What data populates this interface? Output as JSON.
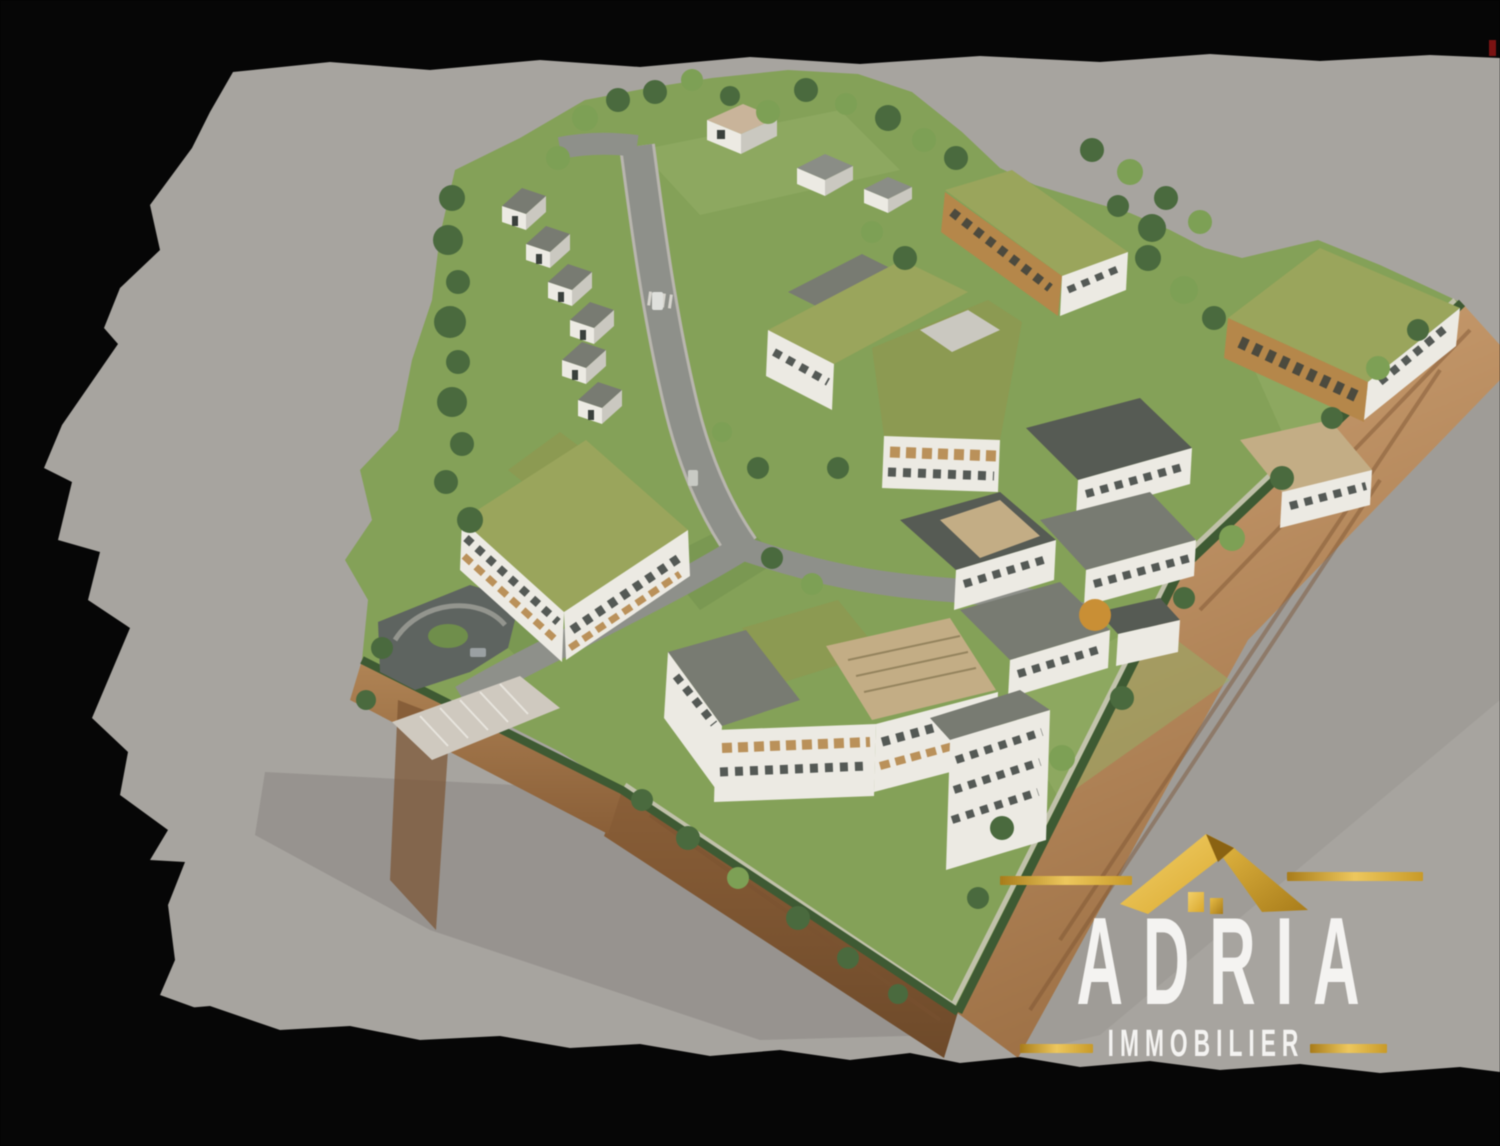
{
  "meta": {
    "type": "aerial-3d-architectural-rendering",
    "subject": "Residential development masterplan: green-roof apartment buildings, a row of terraced houses, internal roads, parking areas and landscaped grounds on a cut-away terrain slab, floating on a torn gray backdrop over black"
  },
  "logo": {
    "brand": "ADRIA",
    "tagline": "IMMOBILIER"
  },
  "palette": {
    "black": "#060606",
    "backdrop": "#a7a49f",
    "backdrop_shadow": "#918e89",
    "grass": "#84a158",
    "grass_light": "#96b068",
    "grass_dark": "#6f8e4b",
    "hedge": "#3e5a33",
    "tree": "#4a6a3e",
    "tree_light": "#7da055",
    "tree_orange": "#c98f35",
    "road": "#8e908a",
    "road_light": "#b8b5ae",
    "concrete": "#cfc9bf",
    "asphalt": "#5e6460",
    "roof_green": "#9aa55c",
    "roof_green2": "#8c9a52",
    "roof_gray": "#787b72",
    "roof_dark": "#565b54",
    "roof_tan": "#c3ad85",
    "wall_white": "#eceae3",
    "wall_shade": "#cac8c0",
    "wood": "#b5874a",
    "window": "#3a403c",
    "earth_light": "#c79c6b",
    "earth_mid": "#a4764a",
    "earth_dark": "#7a5330",
    "gold": "#d9a72c",
    "gold_dark": "#a87c1a",
    "gold_light": "#edc75d",
    "logo_text": "#f4f3f1",
    "red_speck": "#7a1212"
  }
}
